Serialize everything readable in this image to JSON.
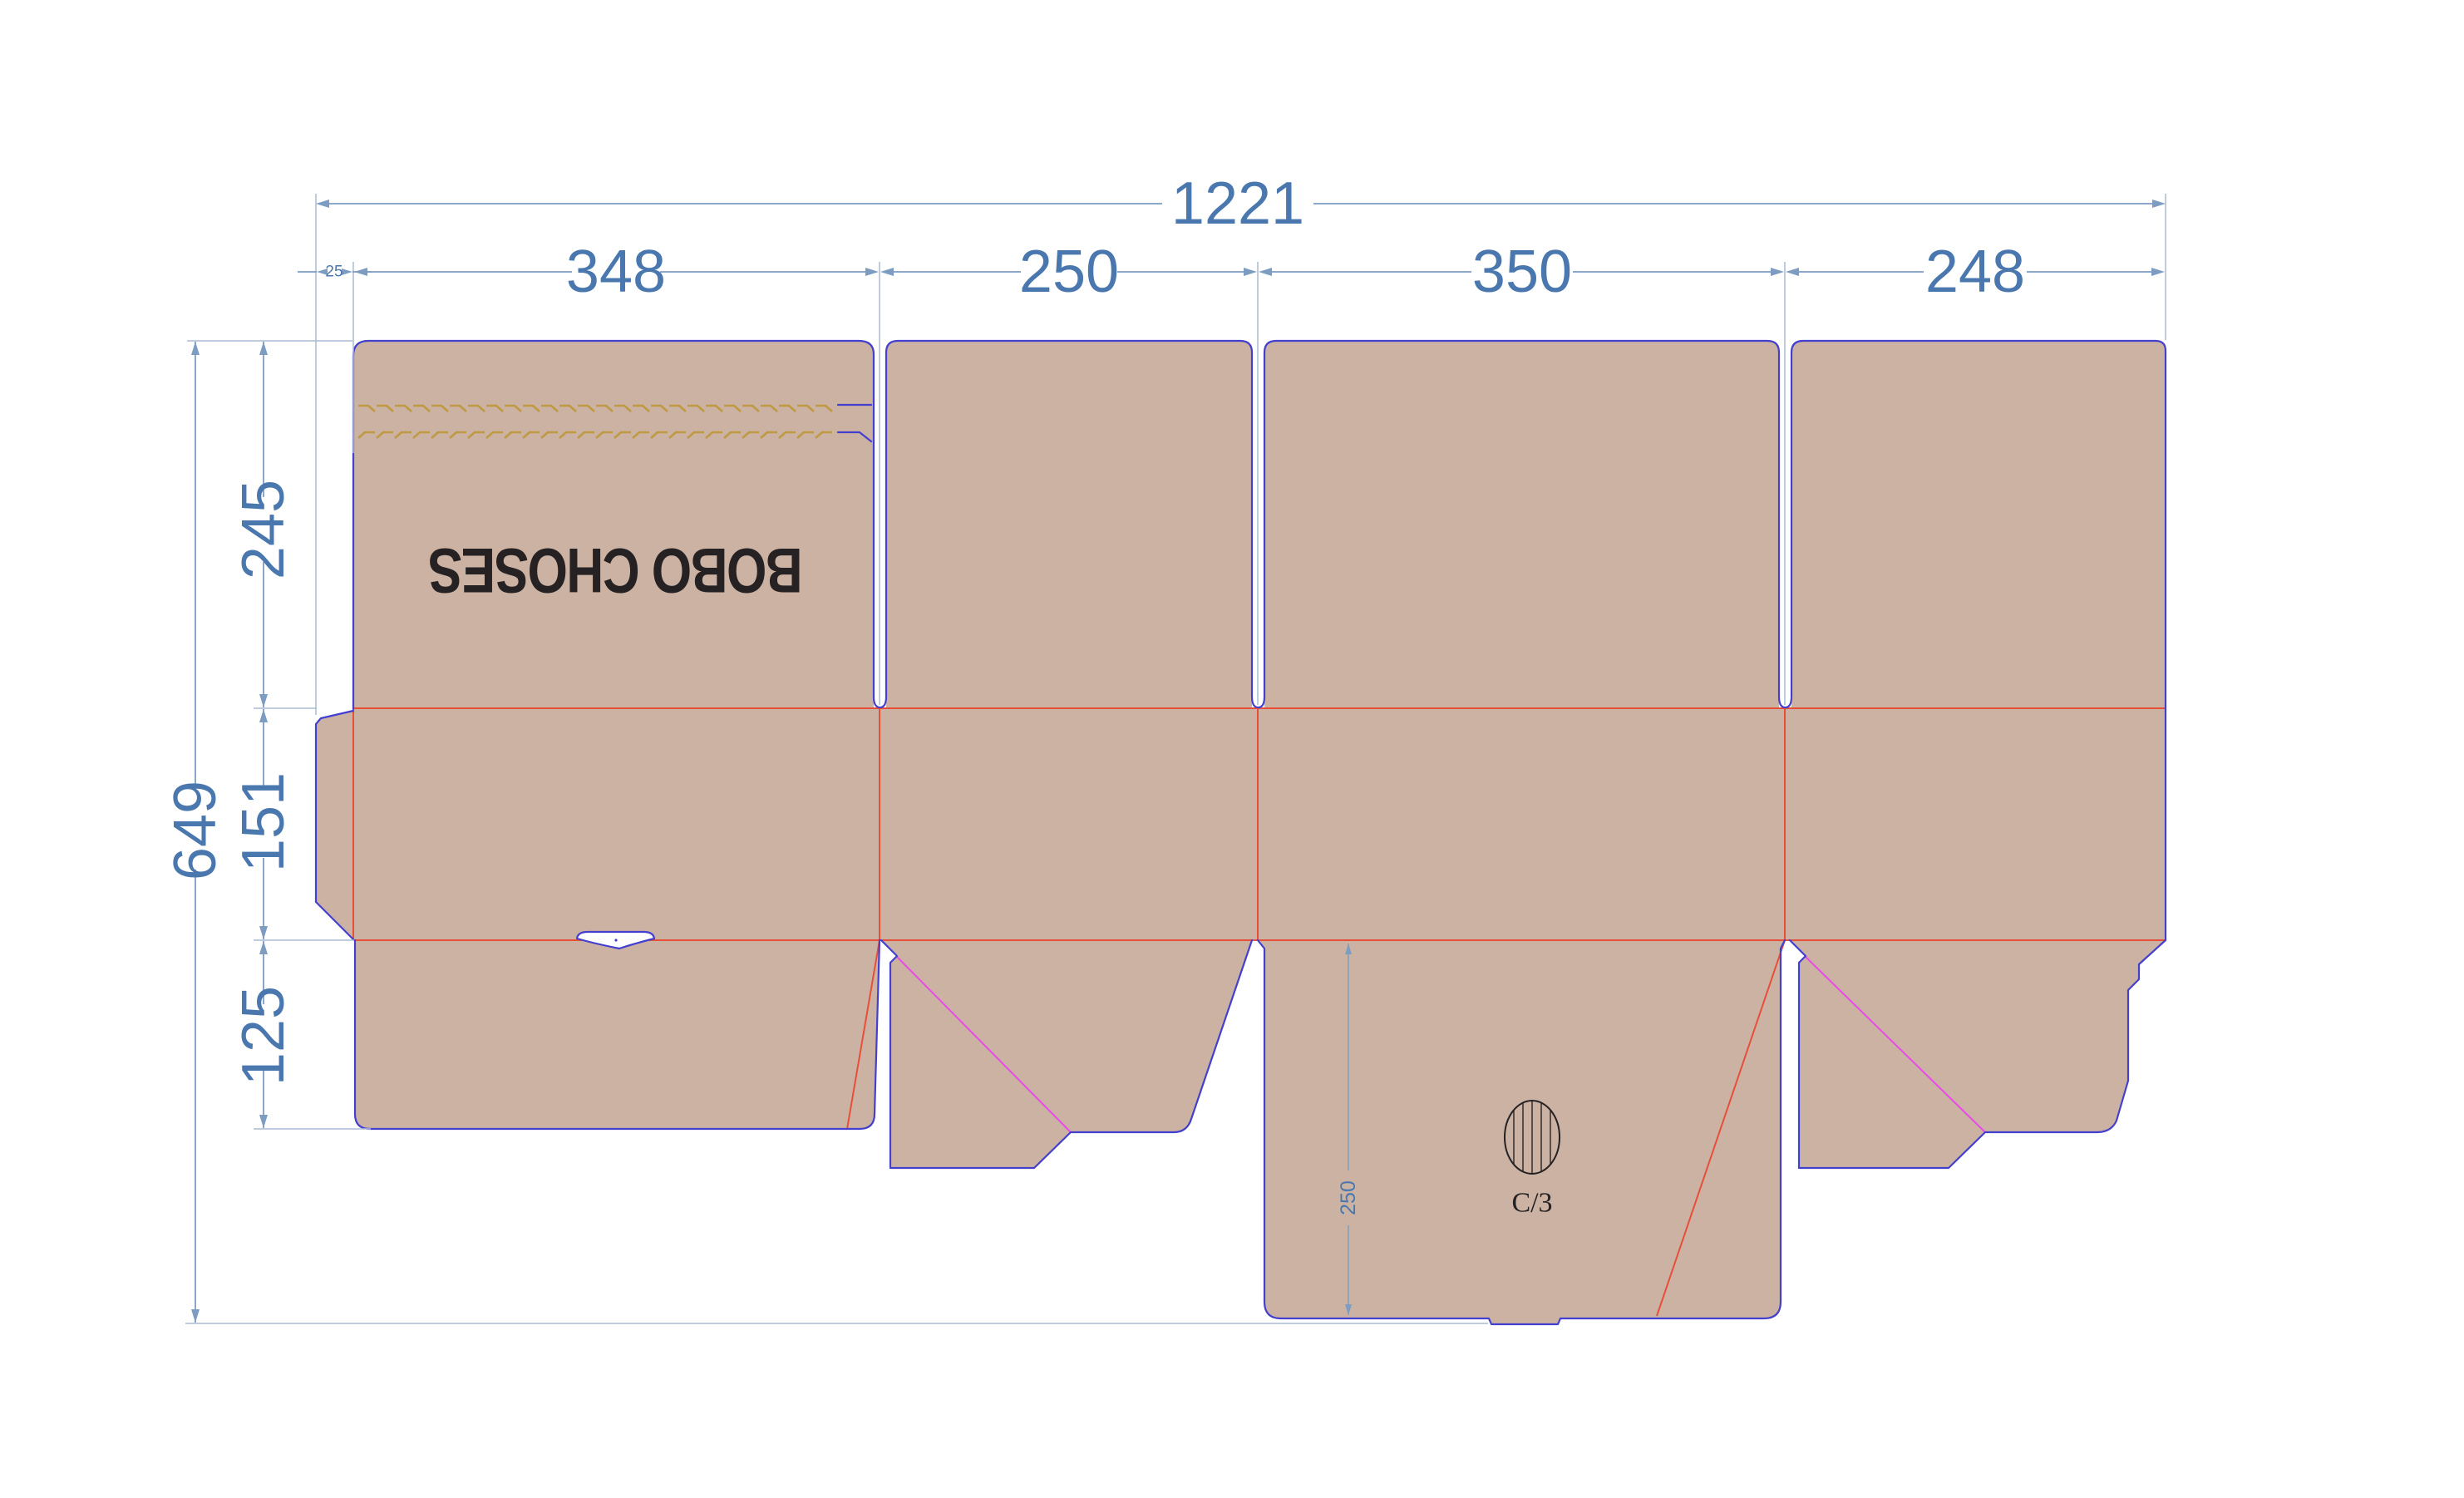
{
  "drawing": {
    "brand_text": "BOBO CHOSES",
    "board_grade": "C/3"
  },
  "dimensions": {
    "horizontal": {
      "total": "1221",
      "glue_tab": "25",
      "panel_1": "348",
      "panel_2": "250",
      "panel_3": "350",
      "panel_4": "248"
    },
    "vertical": {
      "total": "649",
      "top_flap": "245",
      "body": "151",
      "bottom_flap": "125",
      "lock_flap": "250"
    }
  },
  "colors": {
    "panel": "#cbb2a3",
    "cut": "#4340cf",
    "crease": "#e84e38",
    "glue_fold": "#e94ae9",
    "tear": "#c09a42",
    "dim_text": "#4a78ae",
    "dim_line": "#7d9cc2",
    "ext_line": "#a9bcd4",
    "ink": "#262223",
    "bg": "#ffffff"
  }
}
